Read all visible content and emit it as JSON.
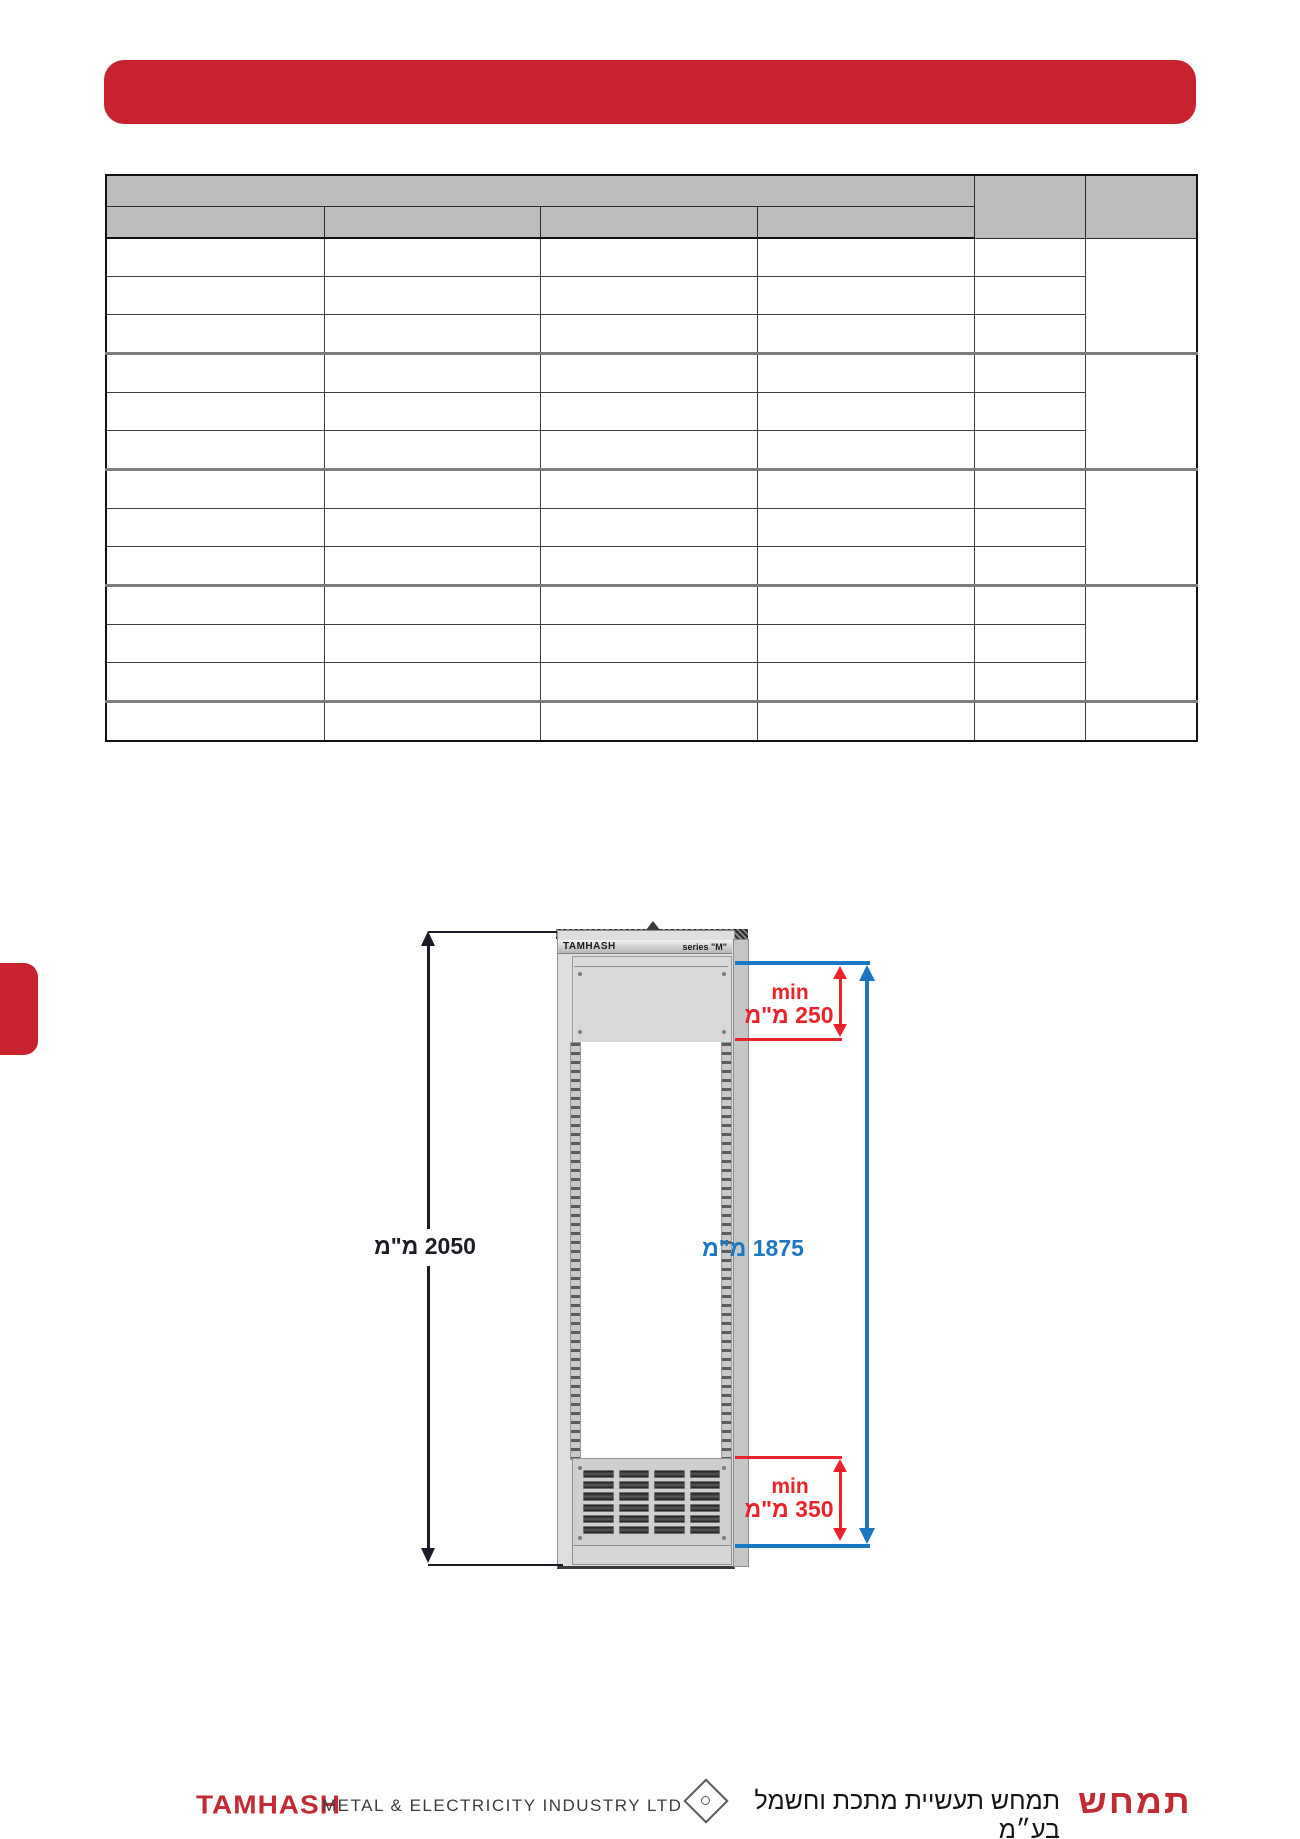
{
  "colors": {
    "brand_red": "#c8222f",
    "dimension_red": "#e8232a",
    "dimension_blue": "#1b78c0",
    "dimension_black": "#1c1c26",
    "table_header_gray": "#bdbdbf"
  },
  "table": {
    "column_widths": [
      218,
      216,
      217,
      217,
      111,
      112
    ],
    "header_rows": 2,
    "body_rows": 13,
    "group_size": 3
  },
  "diagram": {
    "cabinet": {
      "brand": "TAMHASH",
      "series_label": "series \"M\"",
      "grille": {
        "cols": 4,
        "rows": 6
      }
    },
    "dimensions": {
      "overall": "2050 מ\"מ",
      "inner": "1875 מ\"מ",
      "top_min_label": "min",
      "top_min_value": "250 מ\"מ",
      "bottom_min_label": "min",
      "bottom_min_value": "350 מ\"מ"
    }
  },
  "footer": {
    "logo_en": "TAMHASH",
    "tagline_en": "METAL & ELECTRICITY  INDUSTRY  LTD",
    "company_he": "תמחש תעשיית מתכת וחשמל בע״מ",
    "logo_he": "תמחש"
  }
}
